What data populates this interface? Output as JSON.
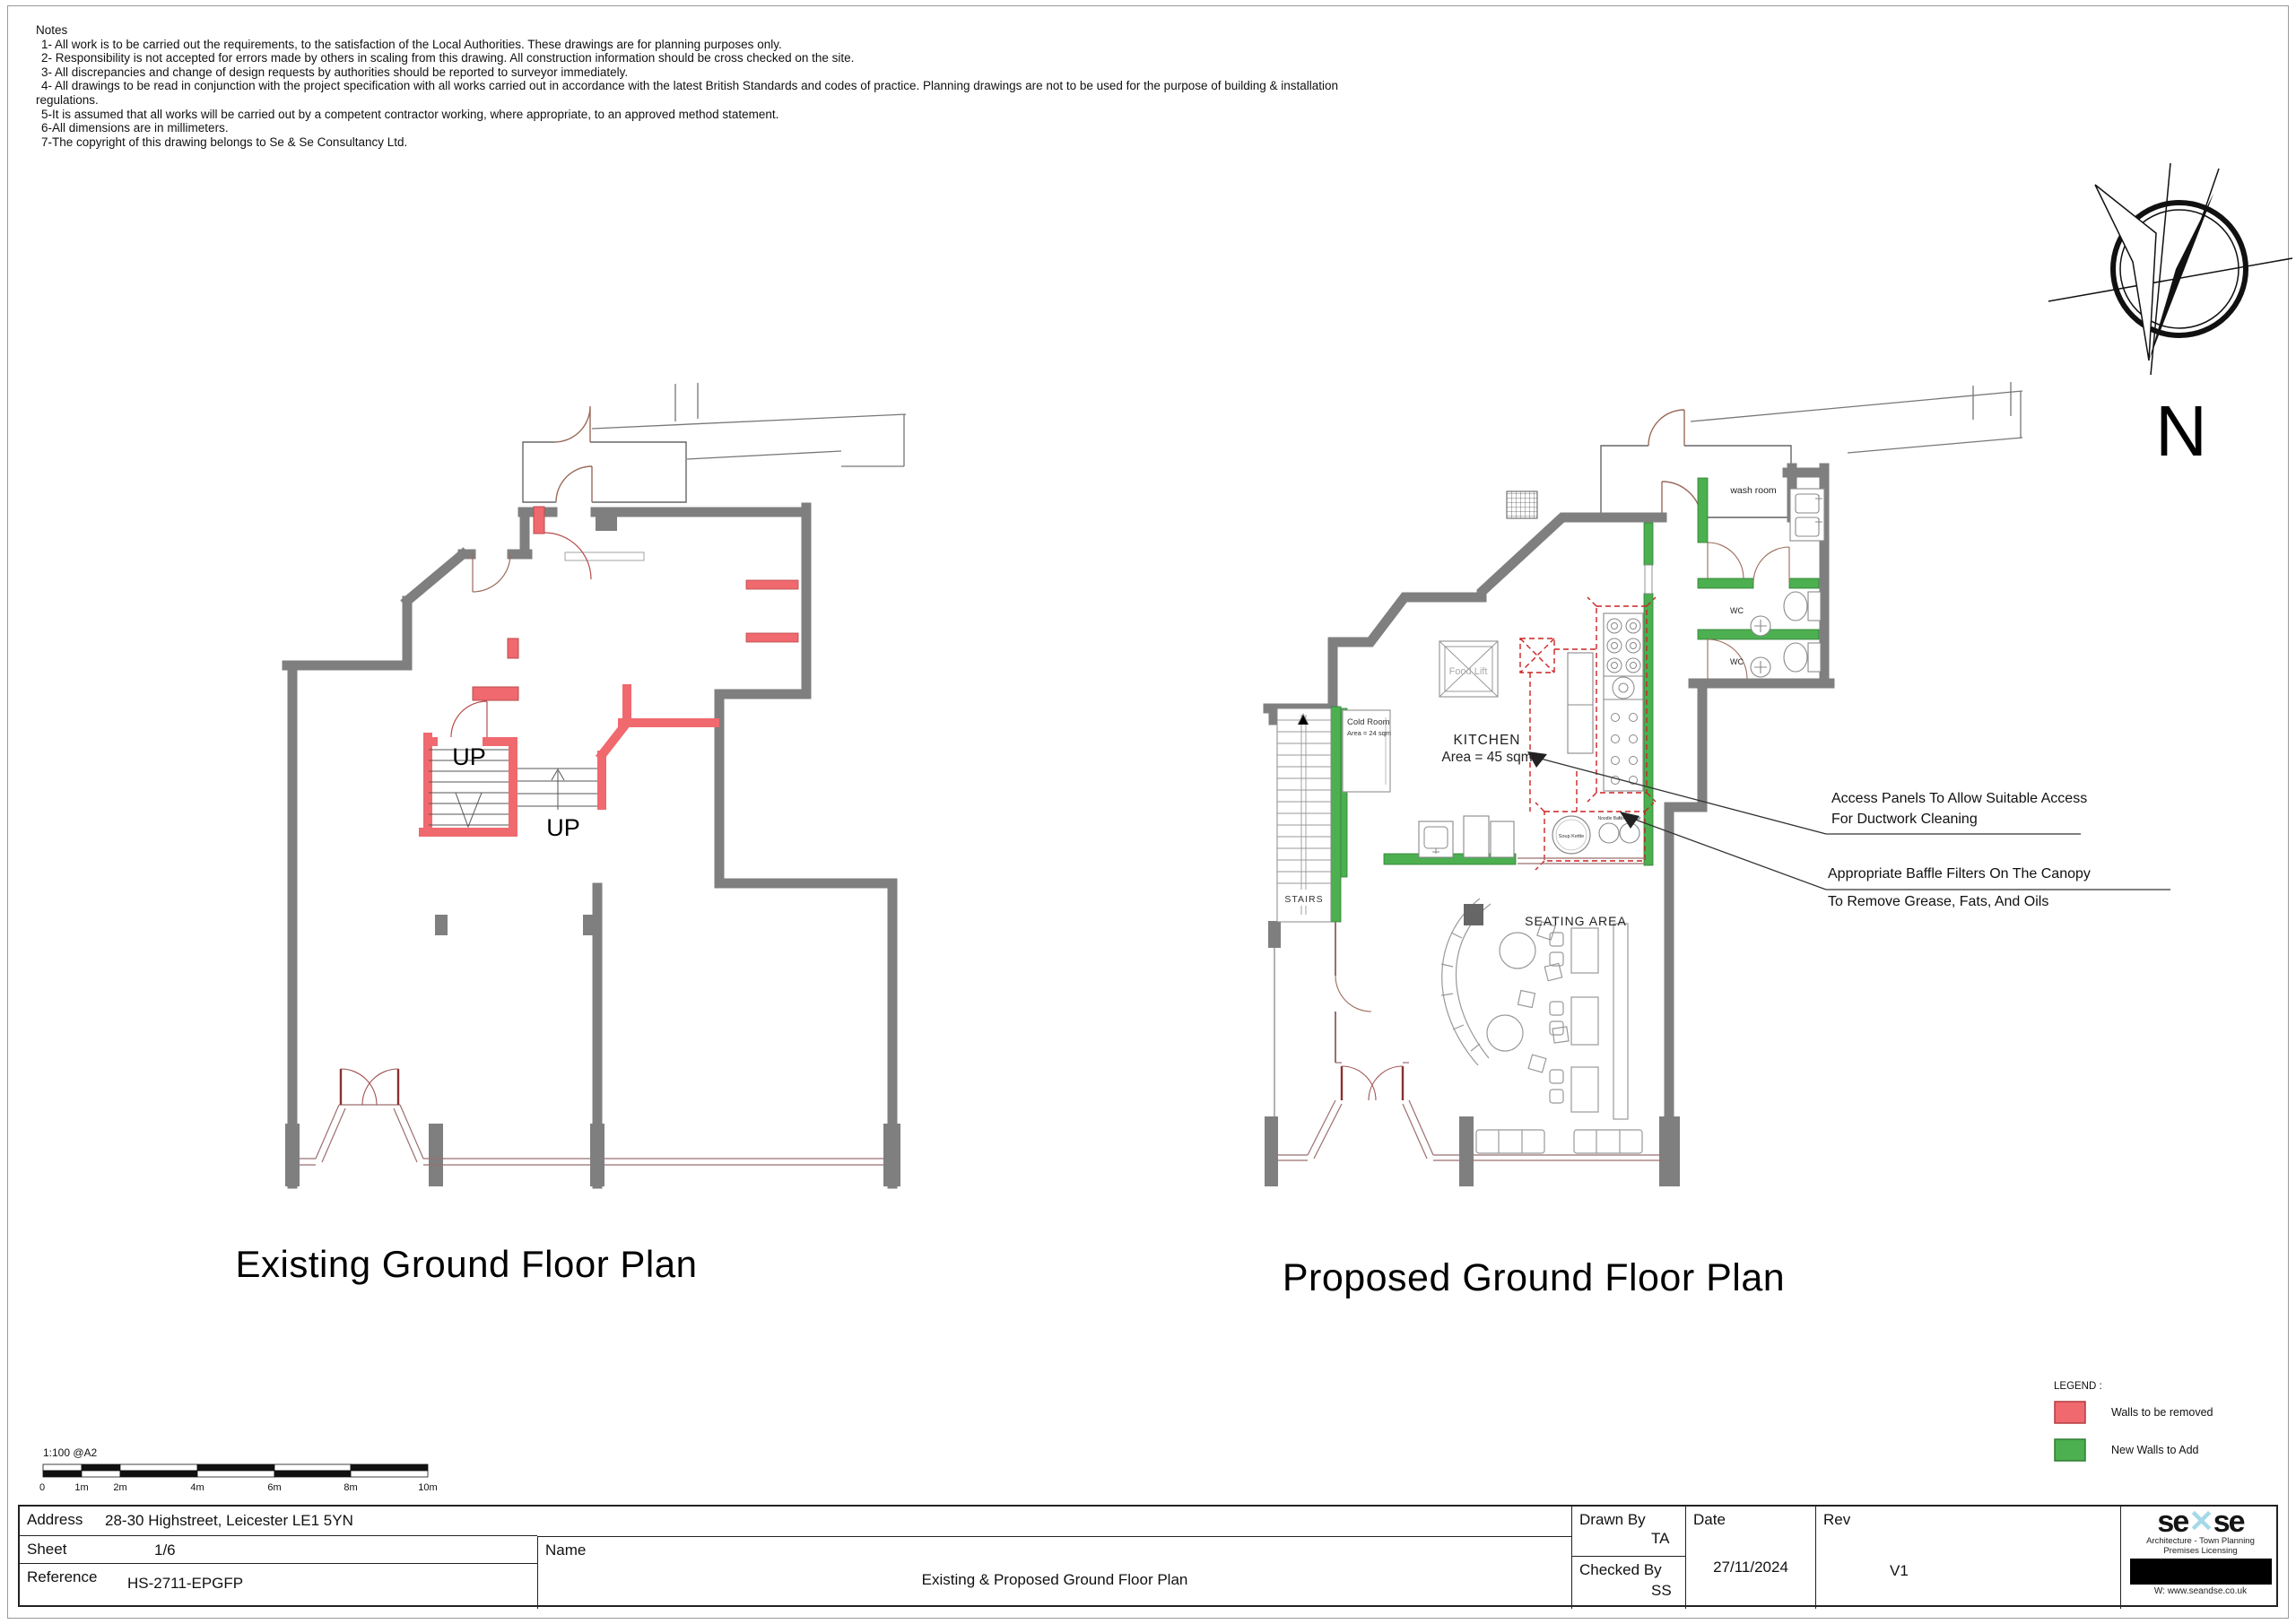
{
  "notes": {
    "title": "Notes",
    "items": [
      "1- All work is to be carried out the requirements, to the satisfaction of the Local Authorities. These drawings are for planning purposes only.",
      "2- Responsibility is not accepted for errors made by others in scaling from this drawing. All construction information should be cross checked on the site.",
      "3- All discrepancies and change of design requests by authorities should be reported to surveyor immediately.",
      "4- All drawings to be read in conjunction with the project specification with all works carried out in accordance with the latest British Standards and codes of practice. Planning drawings are not to be used for the purpose of building & installation",
      "regulations.",
      "5-It is assumed that all works will be carried out by a competent contractor working, where appropriate, to an approved method statement.",
      "6-All dimensions are in millimeters.",
      "7-The copyright of this drawing belongs to Se & Se Consultancy Ltd."
    ]
  },
  "compass": {
    "north_label": "N"
  },
  "existing_plan": {
    "title": "Existing Ground Floor Plan",
    "labels": {
      "up": "UP"
    }
  },
  "proposed_plan": {
    "title": "Proposed Ground Floor Plan",
    "labels": {
      "wash_room": "wash room",
      "wc": "WC",
      "food_lift": "Food Lift",
      "cold_room_name": "Cold Room",
      "cold_room_area": "Area = 24 sqm",
      "kitchen_name": "KITCHEN",
      "kitchen_area": "Area = 45 sqm",
      "stairs": "STAIRS",
      "seating_area": "SEATING AREA",
      "soup_kettle": "Soup Kettle",
      "noodle_bar": "Noodle Bar"
    }
  },
  "annotations": {
    "access_panels_line1": "Access Panels To Allow Suitable Access",
    "access_panels_line2": "For Ductwork Cleaning",
    "baffle_filters_line1": "Appropriate Baffle Filters On The Canopy",
    "baffle_filters_line2": "To Remove Grease, Fats, And Oils"
  },
  "legend": {
    "title": "LEGEND :",
    "items": [
      {
        "label": "Walls to be removed",
        "color": "#f0696e"
      },
      {
        "label": "New Walls to  Add",
        "color": "#4caf50"
      }
    ]
  },
  "scale_bar": {
    "ratio": "1:100 @A2",
    "ticks": [
      "0",
      "1m",
      "2m",
      "4m",
      "6m",
      "8m",
      "10m"
    ]
  },
  "title_block": {
    "address_label": "Address",
    "address_value": "28-30 Highstreet, Leicester LE1 5YN",
    "sheet_label": "Sheet",
    "sheet_value": "1/6",
    "reference_label": "Reference",
    "reference_value": "HS-2711-EPGFP",
    "name_label": "Name",
    "name_value": "Existing & Proposed Ground Floor Plan",
    "drawn_by_label": "Drawn By",
    "drawn_by_value": "TA",
    "checked_by_label": "Checked By",
    "checked_by_value": "SS",
    "date_label": "Date",
    "date_value": "27/11/2024",
    "rev_label": "Rev",
    "rev_value": "V1"
  },
  "logo": {
    "brand_left": "se",
    "brand_mark": "✕",
    "brand_right": "se",
    "tagline_line1": "Architecture - Town Planning",
    "tagline_line2": "Premises Licensing",
    "website": "W: www.seandse.co.uk",
    "accent_color": "#a6d9e8"
  },
  "colors": {
    "wall_gray": "#7f7f7f",
    "wall_remove_red": "#f0696e",
    "wall_add_green": "#4caf50",
    "dashed_red": "#cc2222",
    "shopfront_brown": "#9b6f6f",
    "door_leaf_red": "#8b3030"
  }
}
